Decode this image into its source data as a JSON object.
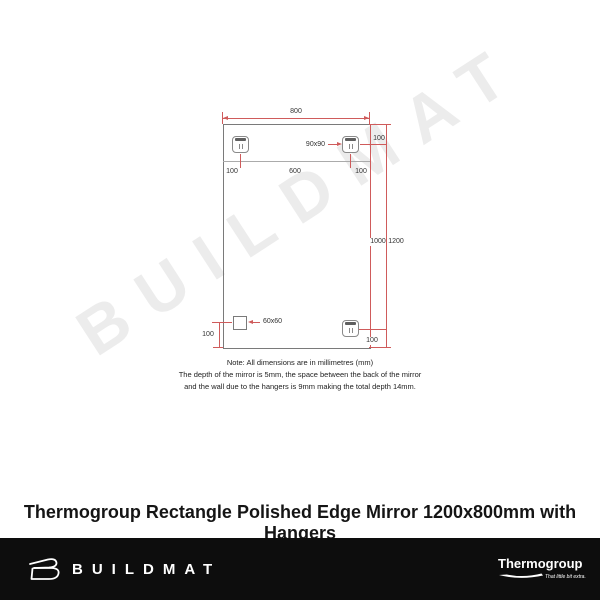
{
  "watermark": {
    "text": "BUILDMAT",
    "color": "#ececec"
  },
  "diagram": {
    "dim_800": "800",
    "dim_100_left": "100",
    "dim_600": "600",
    "dim_100_right": "100",
    "hanger_size_label": "90x90",
    "dim_100_top_right": "100",
    "dim_1000": "1000",
    "dim_1200": "1200",
    "square_size_label": "60x60",
    "dim_100_bottom_left": "100",
    "dim_100_bottom_right": "100",
    "note_line1": "Note: All dimensions are in millimetres (mm)",
    "note_line2": "The depth of the mirror is 5mm, the space between the back of the mirror",
    "note_line3": "and the wall due to the hangers is 9mm making the total depth 14mm.",
    "colors": {
      "dimension_line": "#cf5b5b",
      "outline": "#7a7a7a"
    }
  },
  "title": "Thermogroup Rectangle Polished Edge Mirror 1200x800mm with Hangers",
  "footer": {
    "brand": "BUILDMAT",
    "partner_brand": "Thermogroup",
    "partner_tagline": "That little bit extra...",
    "background": "#0d0d0d"
  }
}
